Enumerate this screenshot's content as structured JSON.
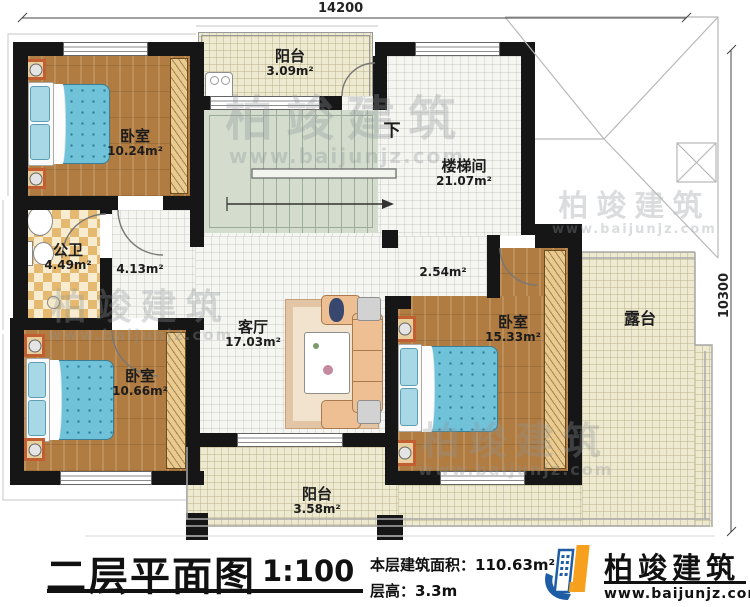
{
  "meta": {
    "floor_title": "二层平面图",
    "scale": "1:100",
    "area_label": "本层建筑面积：",
    "area_value": "110.63m²",
    "floor_height_label": "层高：",
    "floor_height_value": "3.3m"
  },
  "brand": {
    "name": "柏竣建筑",
    "url": "www.baijunjz.com"
  },
  "watermark": {
    "name": "柏竣建筑",
    "url": "www.baijunjz.com"
  },
  "dimensions": {
    "top": "14200",
    "right": "10300"
  },
  "rooms": [
    {
      "id": "bedroom-top-left",
      "name": "卧室",
      "area": "10.24m²"
    },
    {
      "id": "bathroom",
      "name": "公卫",
      "area": "4.49m²"
    },
    {
      "id": "balcony-top",
      "name": "阳台",
      "area": "3.09m²"
    },
    {
      "id": "stairwell",
      "name": "楼梯间",
      "area": "21.07m²"
    },
    {
      "id": "living-room",
      "name": "客厅",
      "area": "17.03m²"
    },
    {
      "id": "bedroom-bottom-left",
      "name": "卧室",
      "area": "10.66m²"
    },
    {
      "id": "bedroom-right",
      "name": "卧室",
      "area": "15.33m²"
    },
    {
      "id": "balcony-bottom",
      "name": "阳台",
      "area": "3.58m²"
    },
    {
      "id": "terrace",
      "name": "露台",
      "area": ""
    }
  ],
  "labels": {
    "corridor_a": "4.13m²",
    "corridor_b": "2.54m²",
    "stairs_down": "下"
  },
  "colors": {
    "wall": "#161616",
    "wood_floor": "#b07c41",
    "bed_quilt": "#70c2d9",
    "tile_cream": "#eeead1",
    "bath_checker": "#e5ba70",
    "stair_floor": "#d3dccd",
    "brand_blue": "#1e5ca6",
    "brand_orange": "#f6a01d"
  }
}
